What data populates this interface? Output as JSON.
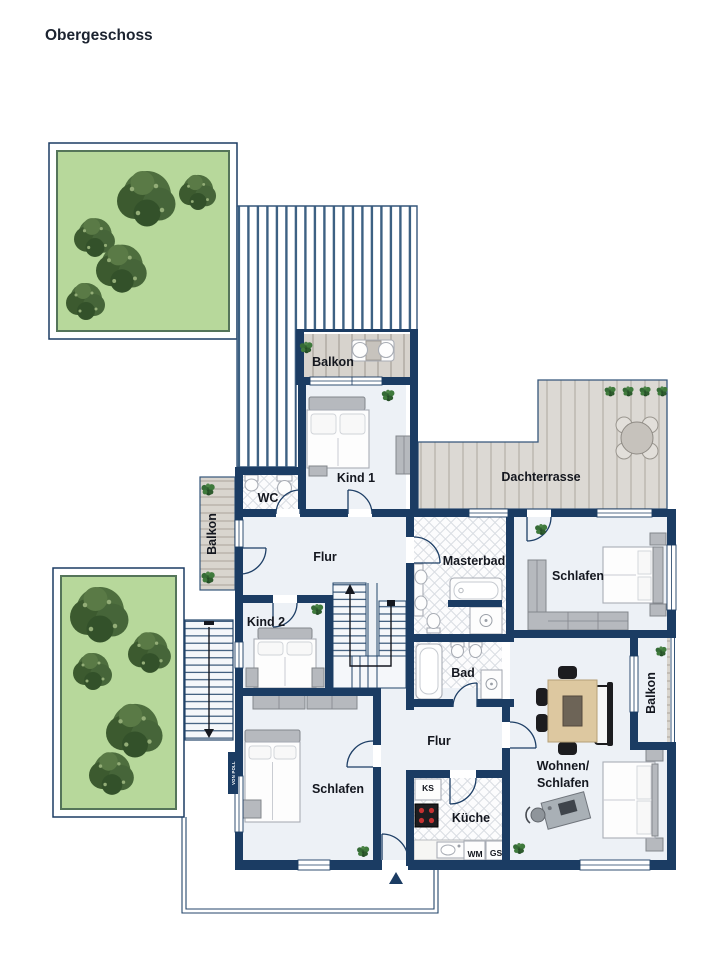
{
  "title": "Obergeschoss",
  "watermark": "VON POLL",
  "rooms": {
    "balkon_top": {
      "label": "Balkon"
    },
    "kind1": {
      "label": "Kind 1"
    },
    "wc": {
      "label": "WC"
    },
    "dachterrasse": {
      "label": "Dachterrasse"
    },
    "balkon_left": {
      "label": "Balkon"
    },
    "flur_upper": {
      "label": "Flur"
    },
    "masterbad": {
      "label": "Masterbad"
    },
    "schlafen_upper": {
      "label": "Schlafen"
    },
    "kind2": {
      "label": "Kind 2"
    },
    "bad": {
      "label": "Bad"
    },
    "balkon_right": {
      "label": "Balkon"
    },
    "flur_lower": {
      "label": "Flur"
    },
    "wohnen_schlafen": {
      "label_line1": "Wohnen/",
      "label_line2": "Schlafen"
    },
    "schlafen_lower": {
      "label": "Schlafen"
    },
    "kueche": {
      "label": "Küche"
    }
  },
  "appliances": {
    "fridge": "KS",
    "washing_machine": "WM",
    "dishwasher": "GS"
  },
  "colors": {
    "wall": "#1b3c63",
    "floor": "#edf1f6",
    "deck": "#d8d5cf",
    "lawn": "#b7d89b",
    "stripe": "#3d6183",
    "tree": "#46673a"
  }
}
